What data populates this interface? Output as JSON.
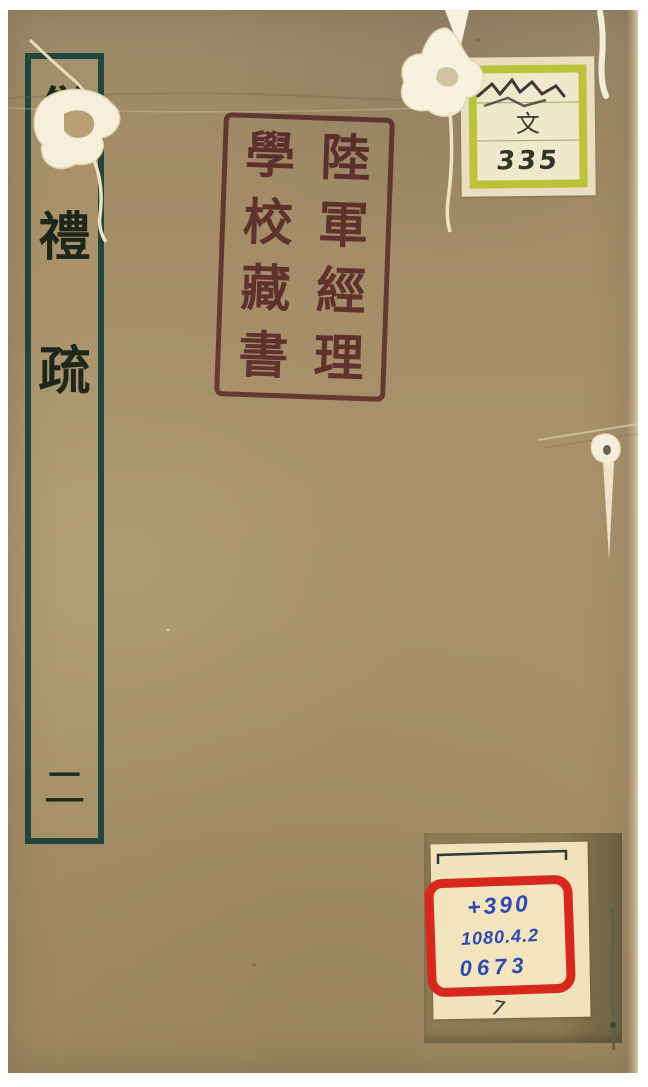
{
  "cover": {
    "paper_color": "#a8916a",
    "title_slip": {
      "characters": [
        "儀",
        "禮",
        "疏"
      ],
      "volume_character": "二",
      "border_color": "#20463d",
      "ink_color": "#2b423a"
    },
    "seal": {
      "full_text": "陸軍經理學校藏書",
      "right_column": [
        "陸",
        "軍",
        "經",
        "理"
      ],
      "left_column": [
        "學",
        "校",
        "藏",
        "書"
      ],
      "ink_color": "#8d5066"
    },
    "classification_label": {
      "category_character": "文",
      "shelf_number": "335",
      "border_color": "#b9c43c",
      "paper_color": "#f0e8cb"
    },
    "call_number_label": {
      "lines": [
        "+390",
        "1080.4.2",
        "0673"
      ],
      "stray_mark": "7",
      "box_color": "#d6281d",
      "ink_color": "#2e4ab2",
      "paper_color": "#f0e2ba"
    }
  },
  "colors": {
    "cover_top": "#9c8b6c",
    "cover_main": "#a8916a",
    "tape_patch": "#8a7952",
    "tear_paper": "#f7f1e0"
  }
}
